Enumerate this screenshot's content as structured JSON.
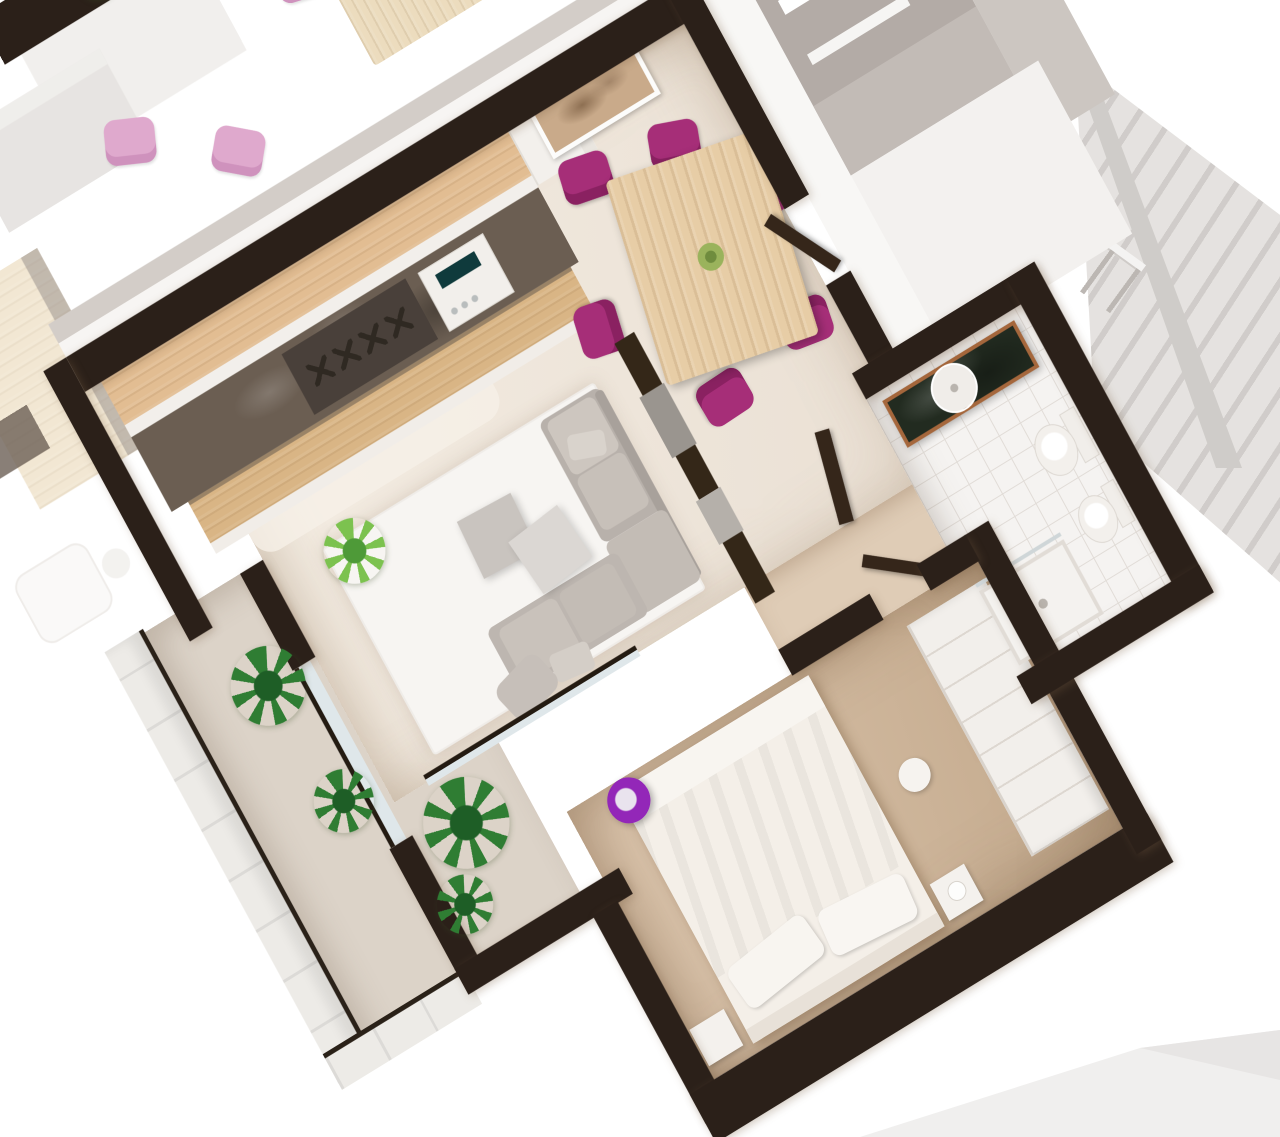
{
  "scene": {
    "description": "3D cutaway floor plan render of a one-bedroom apartment viewed from above, rotated about 30 degrees, surrounded by faded neighboring units, a stairwell and balconies on a white background",
    "rotation_deg": -30,
    "background": "#ffffff"
  },
  "palette": {
    "wall": "#2b2019",
    "wood": "#e2bd92",
    "wood-light": "#eed7b2",
    "wood-island": "#d9b585",
    "wood-table": "#e7cda6",
    "wood-neighbor": "#ead9b8",
    "counter": "#6b5e52",
    "stove": "#49403a",
    "burner": "#2f2922",
    "oven": "#f2efeb",
    "oven-display": "#0f3a3c",
    "floor-main": "#eae0d4",
    "floor-light": "#f4ede3",
    "floor-bed1": "#dcc6ae",
    "floor-bed2": "#c3a98c",
    "floor-hall": "#dfccb6",
    "floor-balcony": "#dcd3c8",
    "parapet": "#edebe7",
    "tile": "#f5f3f1",
    "tile-line": "#e1dcd7",
    "rug": "#f7f5f2",
    "sofa": "#b8b1ab",
    "sofa-light": "#cdc6bf",
    "sofa-mid": "#c3bcb5",
    "sideboard": "#342718",
    "media": "#9a958f",
    "chair": "#a62e78",
    "chair-dark": "#8a2161",
    "chair-pink": "#dfa9cd",
    "door": "#35261a",
    "glass": "#dfe7ea",
    "vanity-wood": "#a5673c",
    "vanity-top": "#222b20",
    "porcelain": "#f3f0ec",
    "porcelain-line": "#dcd7d1",
    "linen": "#f4efe8",
    "linen-dark": "#e7ddd0",
    "purple": "#9327b8",
    "purple-center": "#e9e3ee",
    "plant-l1": "#7cc24f",
    "plant-l2": "#4e9a38",
    "plant-d1": "#2f7d33",
    "plant-d2": "#1e5e26",
    "ngray": "#b3aba6",
    "nfurn": "#d8d4d0",
    "nfloor": "#fbfaf9",
    "stair1": "#e3e0dd",
    "stair2": "#ccc8c5",
    "rail": "#bcb7b3",
    "slab": "#f0efee",
    "slab2": "#e7e5e4"
  },
  "apartment": {
    "rooms": [
      {
        "name": "kitchen"
      },
      {
        "name": "dining-area"
      },
      {
        "name": "living-room"
      },
      {
        "name": "hallway"
      },
      {
        "name": "bathroom"
      },
      {
        "name": "bedroom"
      },
      {
        "name": "balcony"
      }
    ],
    "furniture": {
      "kitchen": [
        "wall-cabinets",
        "tall-cabinet",
        "marble-counter",
        "stove-with-4-burners",
        "oven",
        "island-counter"
      ],
      "dining": [
        "wooden-table",
        "green-centerpiece",
        "magenta-chairs-x6",
        "wall-picture"
      ],
      "living": [
        "area-rug",
        "corner-sofa",
        "seat-cushions",
        "pillows",
        "coffee-tables-x2",
        "media-sideboard"
      ],
      "bedroom": [
        "double-bed",
        "duvet",
        "pillows-x2",
        "headboard",
        "nightstands-x2",
        "wardrobe",
        "purple-pouf",
        "round-stool"
      ],
      "bathroom": [
        "wood-vanity",
        "round-basin",
        "toilet",
        "bidet",
        "shower-tray",
        "tiled-floor"
      ],
      "balcony": [
        "glass-parapet",
        "sliding-door",
        "potted-plants"
      ]
    },
    "counts": {
      "dining_chairs": 6,
      "balcony_plants": 3,
      "indoor_plants": 1,
      "neighbor_pink_chairs": 5
    }
  },
  "neighbors": {
    "top_left": [
      "faded-unit-floor",
      "gray-bed",
      "gray-rug",
      "white-armchair",
      "wood-counter"
    ],
    "top": [
      "pink-dining-chairs",
      "light-wood-table",
      "small-plants",
      "dark-wall-fragments",
      "gray-wall-band"
    ],
    "top_right": [
      "gray-wall-slab",
      "balcony-railing-with-posts",
      "white-wall-band"
    ],
    "right": [
      "staircase",
      "stair-railing"
    ],
    "bottom_right": [
      "concrete-slab-triangle"
    ]
  }
}
